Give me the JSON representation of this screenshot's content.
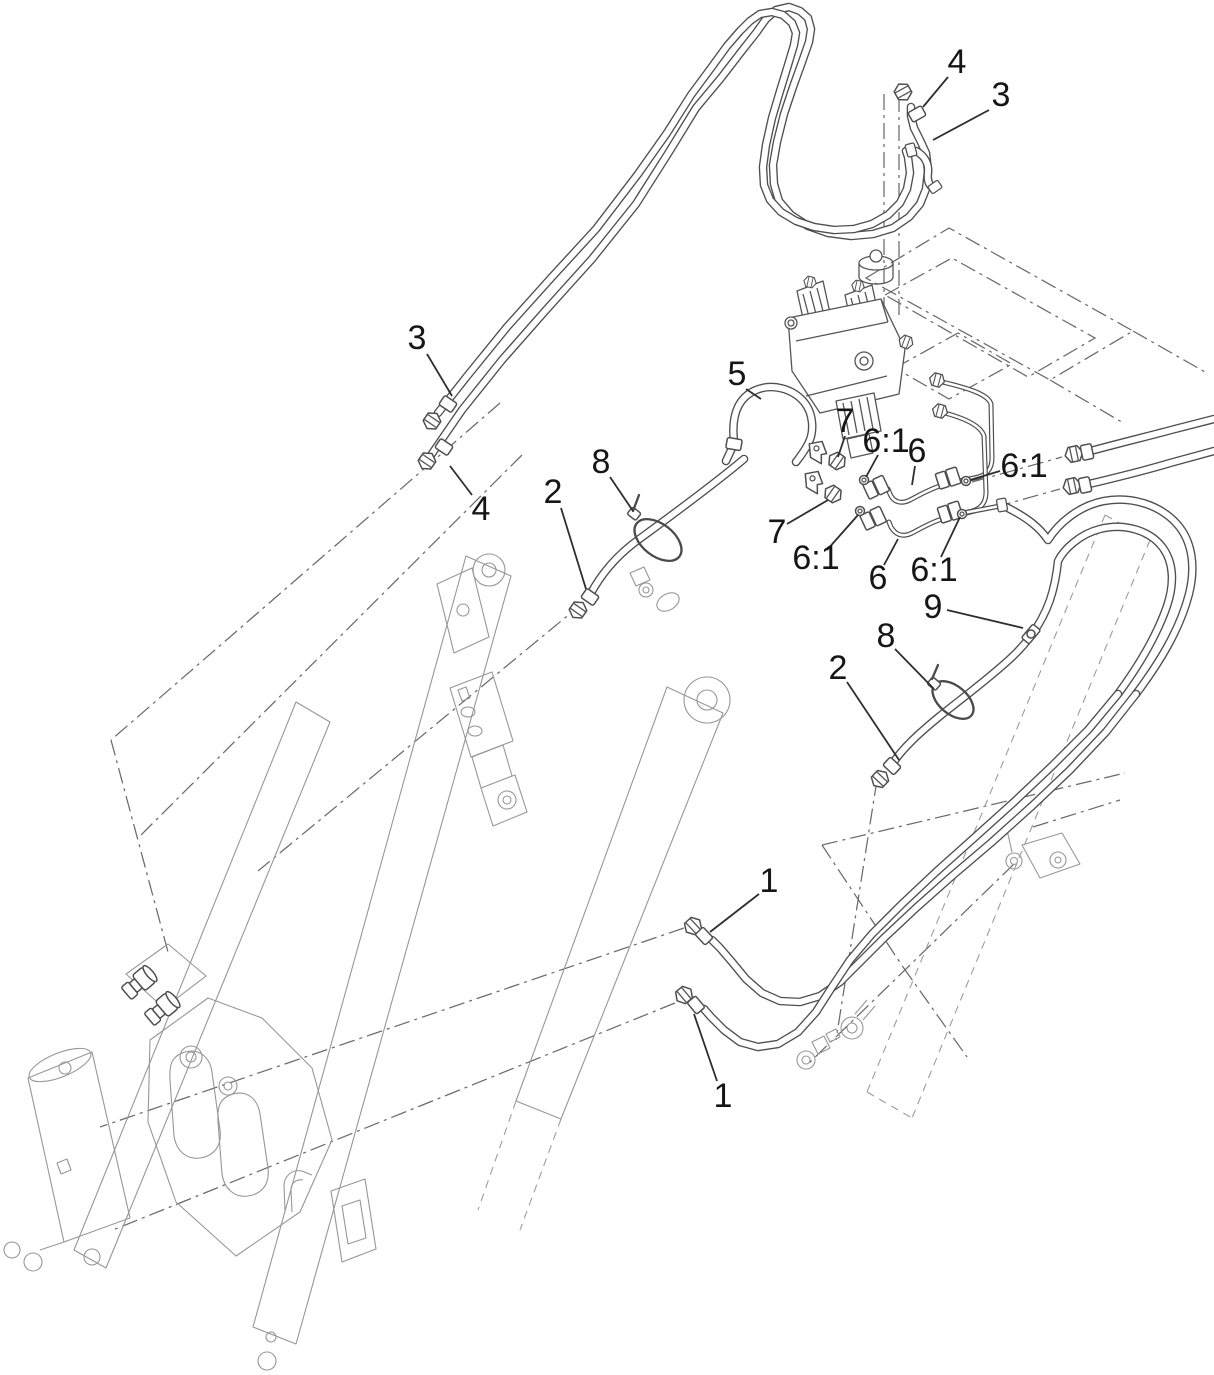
{
  "diagram": {
    "type": "exploded-parts-diagram",
    "subject": "loader-arm-hydraulic-hose-routing",
    "background": "#ffffff",
    "colors": {
      "hose_outline": "#4f4f4f",
      "hose_fill": "#ffffff",
      "phantom_line": "#6b6b6b",
      "frame_line": "#979797",
      "callout_text": "#161616",
      "leader_line": "#2e2e2e"
    },
    "item_numbers": [
      "1",
      "2",
      "3",
      "4",
      "5",
      "6",
      "6:1",
      "7",
      "8",
      "9"
    ],
    "callouts": [
      {
        "label": "4",
        "x": 957,
        "y": 62,
        "leader": [
          948,
          77,
          923,
          107
        ]
      },
      {
        "label": "3",
        "x": 1001,
        "y": 95,
        "leader": [
          989,
          110,
          933,
          140
        ]
      },
      {
        "label": "3",
        "x": 417,
        "y": 338,
        "leader": [
          427,
          354,
          452,
          396
        ]
      },
      {
        "label": "4",
        "x": 481,
        "y": 509,
        "leader": [
          472,
          495,
          450,
          466
        ]
      },
      {
        "label": "2",
        "x": 553,
        "y": 492,
        "leader": [
          561,
          508,
          586,
          589
        ]
      },
      {
        "label": "8",
        "x": 601,
        "y": 462,
        "leader": [
          610,
          477,
          633,
          511
        ]
      },
      {
        "label": "5",
        "x": 737,
        "y": 374,
        "leader": [
          746,
          389,
          761,
          399
        ]
      },
      {
        "label": "7",
        "x": 845,
        "y": 421,
        "leader": [
          845,
          436,
          838,
          457
        ]
      },
      {
        "label": "6:1",
        "x": 886,
        "y": 441,
        "leader": [
          878,
          455,
          866,
          477
        ]
      },
      {
        "label": "6",
        "x": 917,
        "y": 451,
        "leader": [
          915,
          466,
          912,
          485
        ]
      },
      {
        "label": "6:1",
        "x": 1024,
        "y": 466,
        "leader": [
          1000,
          471,
          970,
          480
        ]
      },
      {
        "label": "7",
        "x": 777,
        "y": 532,
        "leader": [
          787,
          524,
          828,
          500
        ]
      },
      {
        "label": "6:1",
        "x": 816,
        "y": 558,
        "leader": [
          827,
          550,
          858,
          515
        ]
      },
      {
        "label": "6",
        "x": 878,
        "y": 578,
        "leader": [
          884,
          565,
          898,
          539
        ]
      },
      {
        "label": "6:1",
        "x": 934,
        "y": 570,
        "leader": [
          941,
          557,
          960,
          517
        ]
      },
      {
        "label": "9",
        "x": 933,
        "y": 607,
        "leader": [
          947,
          610,
          1023,
          628
        ]
      },
      {
        "label": "8",
        "x": 886,
        "y": 636,
        "leader": [
          895,
          649,
          934,
          689
        ]
      },
      {
        "label": "2",
        "x": 838,
        "y": 668,
        "leader": [
          847,
          682,
          899,
          760
        ]
      },
      {
        "label": "1",
        "x": 769,
        "y": 881,
        "leader": [
          759,
          894,
          710,
          932
        ]
      },
      {
        "label": "1",
        "x": 723,
        "y": 1096,
        "leader": [
          717,
          1081,
          694,
          1014
        ]
      }
    ]
  }
}
